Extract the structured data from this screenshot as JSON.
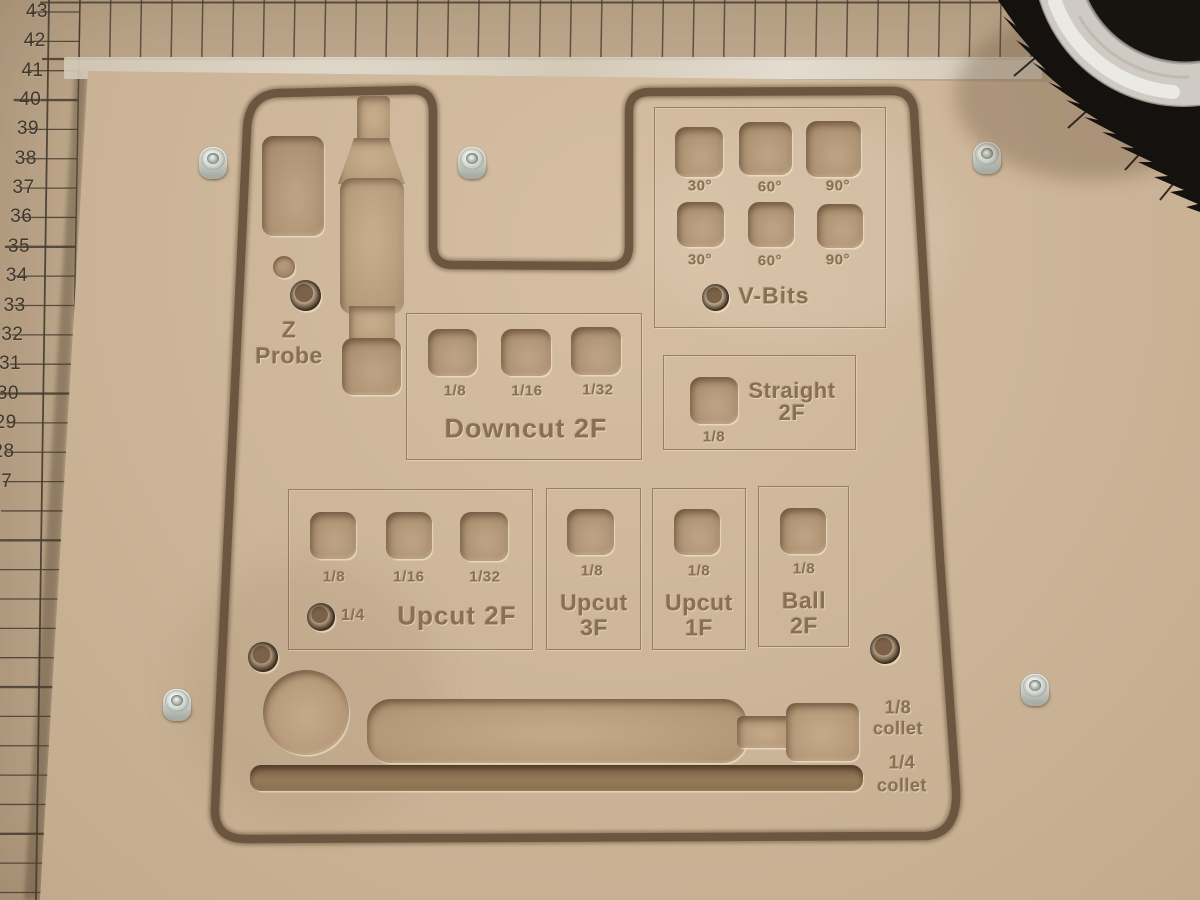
{
  "ruler": {
    "numbers": [
      "43",
      "42",
      "41",
      "40",
      "39",
      "38",
      "37",
      "36",
      "35",
      "34",
      "33",
      "32",
      "31",
      "30",
      "29",
      "28",
      "27"
    ]
  },
  "zprobe": {
    "title_line1": "Z",
    "title_line2": "Probe"
  },
  "panels": {
    "vbits": {
      "title": "V-Bits",
      "row1": [
        "30°",
        "60°",
        "90°"
      ],
      "row2": [
        "30°",
        "60°",
        "90°"
      ]
    },
    "downcut2f": {
      "title": "Downcut 2F",
      "labels": [
        "1/8",
        "1/16",
        "1/32"
      ]
    },
    "straight2f": {
      "title_line1": "Straight",
      "title_line2": "2F",
      "label": "1/8"
    },
    "upcut2f": {
      "title": "Upcut 2F",
      "labels": [
        "1/8",
        "1/16",
        "1/32"
      ],
      "extra_label": "1/4"
    },
    "upcut3f": {
      "title_line1": "Upcut",
      "title_line2": "3F",
      "label": "1/8"
    },
    "upcut1f": {
      "title_line1": "Upcut",
      "title_line2": "1F",
      "label": "1/8"
    },
    "ball2f": {
      "title_line1": "Ball",
      "title_line2": "2F",
      "label": "1/8"
    }
  },
  "collets": {
    "eighth": {
      "line1": "1/8",
      "line2": "collet"
    },
    "quarter": {
      "line1": "1/4",
      "line2": "collet"
    }
  },
  "colors": {
    "board_tan": "#cdb69a",
    "spoilboard_tan": "#c6b095",
    "groove_brown": "#66503a",
    "engraving_brown": "#8a7052",
    "pocket_floor": "#ac9071",
    "grid_line": "#453c31",
    "bristle_black": "#15110e",
    "acrylic_ring": "#d9d5cf",
    "screw_silver": "#d9ddd6"
  }
}
